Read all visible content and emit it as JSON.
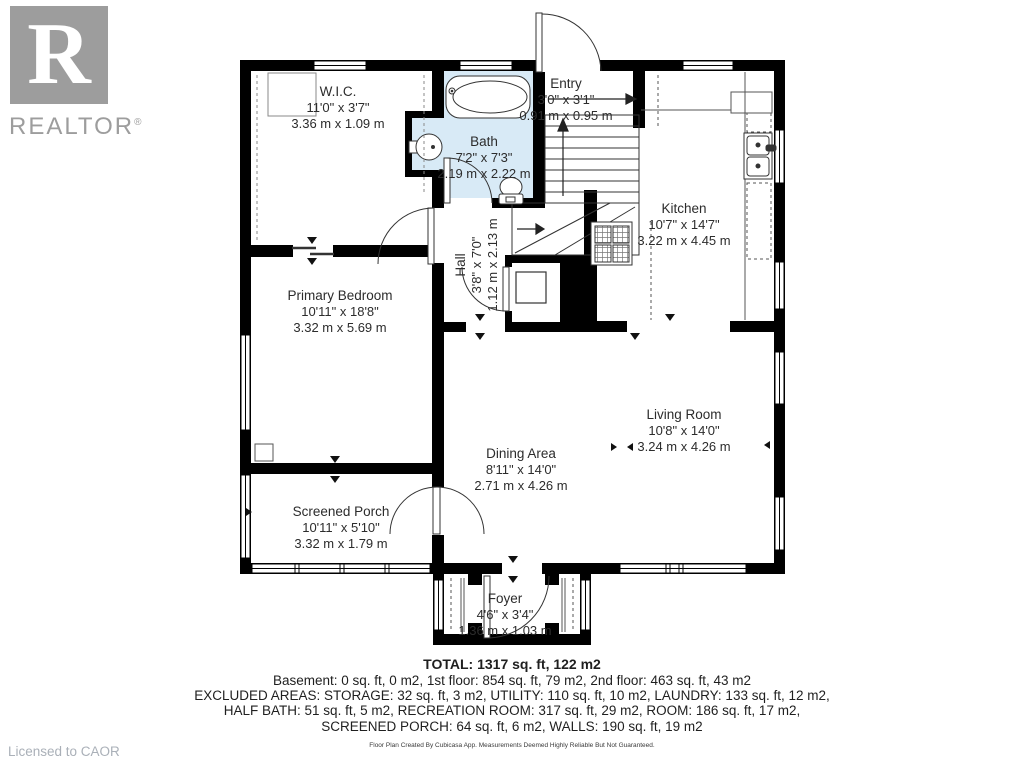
{
  "branding": {
    "logo_letter": "R",
    "logo_text": "REALTOR",
    "registered": "®",
    "licensed_to": "Licensed to CAOR"
  },
  "rooms": [
    {
      "name": "W.I.C.",
      "dim_ft": "11'0\" x 3'7\"",
      "dim_m": "3.36 m x 1.09 m"
    },
    {
      "name": "Bath",
      "dim_ft": "7'2\" x 7'3\"",
      "dim_m": "2.19 m x 2.22 m"
    },
    {
      "name": "Entry",
      "dim_ft": "3'0\" x 3'1\"",
      "dim_m": "0.91 m x 0.95 m"
    },
    {
      "name": "Kitchen",
      "dim_ft": "10'7\" x 14'7\"",
      "dim_m": "3.22 m x 4.45 m"
    },
    {
      "name": "Hall",
      "dim_ft": "3'8\" x 7'0\"",
      "dim_m": "1.12 m x 2.13 m"
    },
    {
      "name": "Primary Bedroom",
      "dim_ft": "10'11\" x 18'8\"",
      "dim_m": "3.32 m x 5.69 m"
    },
    {
      "name": "Living Room",
      "dim_ft": "10'8\" x 14'0\"",
      "dim_m": "3.24 m x 4.26 m"
    },
    {
      "name": "Dining Area",
      "dim_ft": "8'11\" x 14'0\"",
      "dim_m": "2.71 m x 4.26 m"
    },
    {
      "name": "Screened Porch",
      "dim_ft": "10'11\" x 5'10\"",
      "dim_m": "3.32 m x 1.79 m"
    },
    {
      "name": "Foyer",
      "dim_ft": "4'6\" x 3'4\"",
      "dim_m": "1.36 m x 1.03 m"
    }
  ],
  "summary": {
    "total": "TOTAL: 1317 sq. ft, 122 m2",
    "floors": "Basement: 0 sq. ft, 0 m2, 1st floor: 854 sq. ft, 79 m2, 2nd floor: 463 sq. ft, 43 m2",
    "excluded_1": "EXCLUDED AREAS: STORAGE: 32 sq. ft, 3 m2, UTILITY: 110 sq. ft, 10 m2, LAUNDRY: 133 sq. ft, 12 m2,",
    "excluded_2": "HALF BATH: 51 sq. ft, 5 m2, RECREATION ROOM: 317 sq. ft, 29 m2, ROOM: 186 sq. ft, 17 m2,",
    "excluded_3": "SCREENED PORCH: 64 sq. ft, 6 m2, WALLS: 190 sq. ft, 19 m2",
    "disclaimer": "Floor Plan Created By Cubicasa App. Measurements Deemed Highly Reliable But Not Guaranteed."
  },
  "colors": {
    "wall": "#000000",
    "bath_fill": "#d8eaf6",
    "logo_gray": "#9d9d9d"
  }
}
